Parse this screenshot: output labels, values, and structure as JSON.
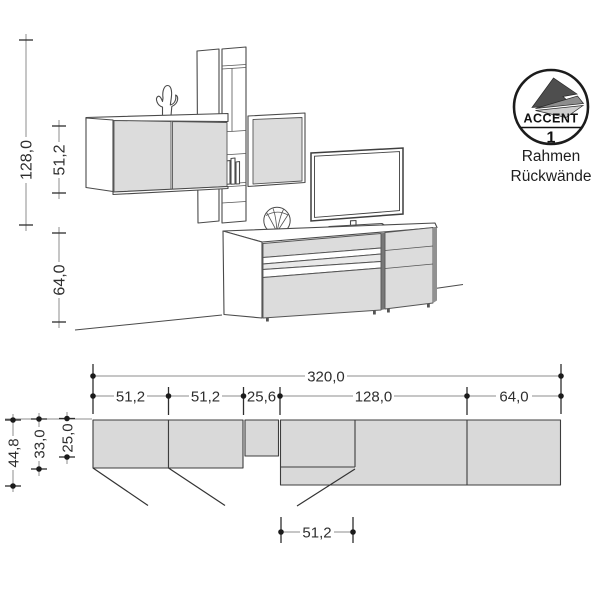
{
  "badge": {
    "label": "ACCENT",
    "number": "1",
    "caption_line1": "Rahmen",
    "caption_line2": "Rückwände"
  },
  "elevation_dims": {
    "total_height": "128,0",
    "upper_height": "51,2",
    "lower_height": "64,0"
  },
  "plan_dims": {
    "total_width": "320,0",
    "segments": [
      "51,2",
      "51,2",
      "25,6",
      "128,0",
      "64,0"
    ],
    "depth_outer": "44,8",
    "depth_mid": "33,0",
    "depth_inner": "25,0",
    "door_width": "51,2"
  },
  "colors": {
    "furniture_fill": "#dcdcdc",
    "plan_fill": "#d9d9d9",
    "shelf_inner_fill": "#e9e9e9",
    "outline": "#4a4a4a",
    "dim_line": "#8e8e8e",
    "dim_text": "#2e2e2e",
    "badge_dark": "#4e4e4e",
    "badge_mid": "#8d8d8d",
    "badge_light": "#cdcdcd"
  }
}
